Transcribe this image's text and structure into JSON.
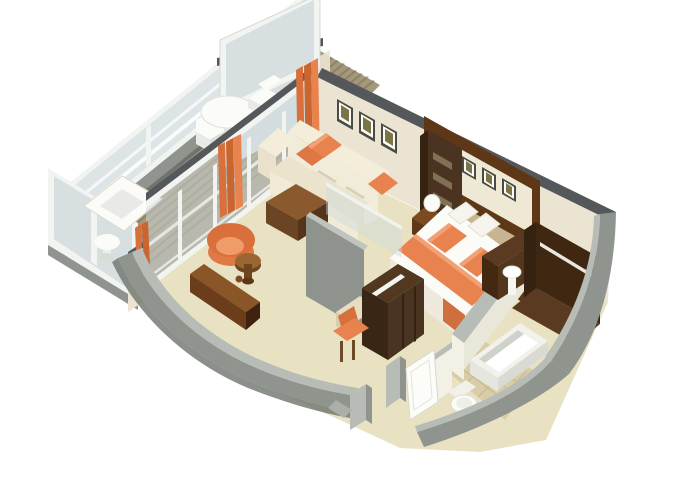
{
  "scene": {
    "kind": "isometric-suite-floorplan-render",
    "rooms": [
      {
        "name": "balcony",
        "furniture": [
          "wood-slat-deck",
          "glass-railing",
          "privacy-divider",
          "round-table",
          "deck-chair",
          "deck-chair",
          "lounger",
          "side-table"
        ]
      },
      {
        "name": "living-room",
        "furniture": [
          "sliding-glass-doors",
          "curtains",
          "sofa",
          "orange-cushions",
          "wall-art-x3",
          "coffee-table",
          "tub-chair",
          "mushroom-side-table",
          "console-desk"
        ]
      },
      {
        "name": "bedroom",
        "furniture": [
          "double-bed",
          "orange-pillows",
          "bed-runner",
          "headboard",
          "wall-art-x3",
          "nightstand-left",
          "nightstand-right",
          "sphere-lamps",
          "shelf-unit",
          "glass-partition",
          "tv-cabinet",
          "desk",
          "desk-chair"
        ]
      },
      {
        "name": "bathroom",
        "furniture": [
          "bathtub",
          "toilet",
          "pedestal-sink",
          "vanity-cabinet",
          "tile-floor",
          "partition-wall"
        ]
      },
      {
        "name": "entry",
        "furniture": [
          "entry-door",
          "door-jambs",
          "corridor-floor",
          "wardrobe-closet",
          "closet-rod"
        ]
      }
    ]
  },
  "palette": {
    "background": "#ffffff",
    "exterior_wall": "#8f948f",
    "exterior_wall_light": "#b7bcb6",
    "exterior_wall_dark": "#6e746e",
    "wall_cap_dark": "#54585a",
    "interior_wall_cream": "#ece4d2",
    "wall_panel_cream": "#efe8d4",
    "floor_beige": "#e8e2c3",
    "bathroom_tile": "#d8cda7",
    "tile_line": "#c3b78e",
    "deck_wood": "#a3977c",
    "deck_stripe": "#7d7158",
    "glass": "#cfd9dc",
    "glass_frame": "#f2f4f1",
    "fabric_cream": "#f1ebd9",
    "fabric_cream_shadow": "#e2d9c2",
    "orange": "#e8824f",
    "orange_light": "#f2a177",
    "orange_dark": "#c9652f",
    "curtain_orange": "#d96f3a",
    "wood_mid": "#7c4a21",
    "wood_dark": "#5e3716",
    "wood_deep": "#3f2310",
    "cabinet_dark": "#4a3320",
    "cabinet_darker": "#362211",
    "headboard_tan": "#c9b491",
    "art_olive": "#7d7446",
    "picture_frame": "#4b4b45",
    "fixture_white": "#fbfbf8",
    "fixture_shadow": "#d8d8d2"
  }
}
